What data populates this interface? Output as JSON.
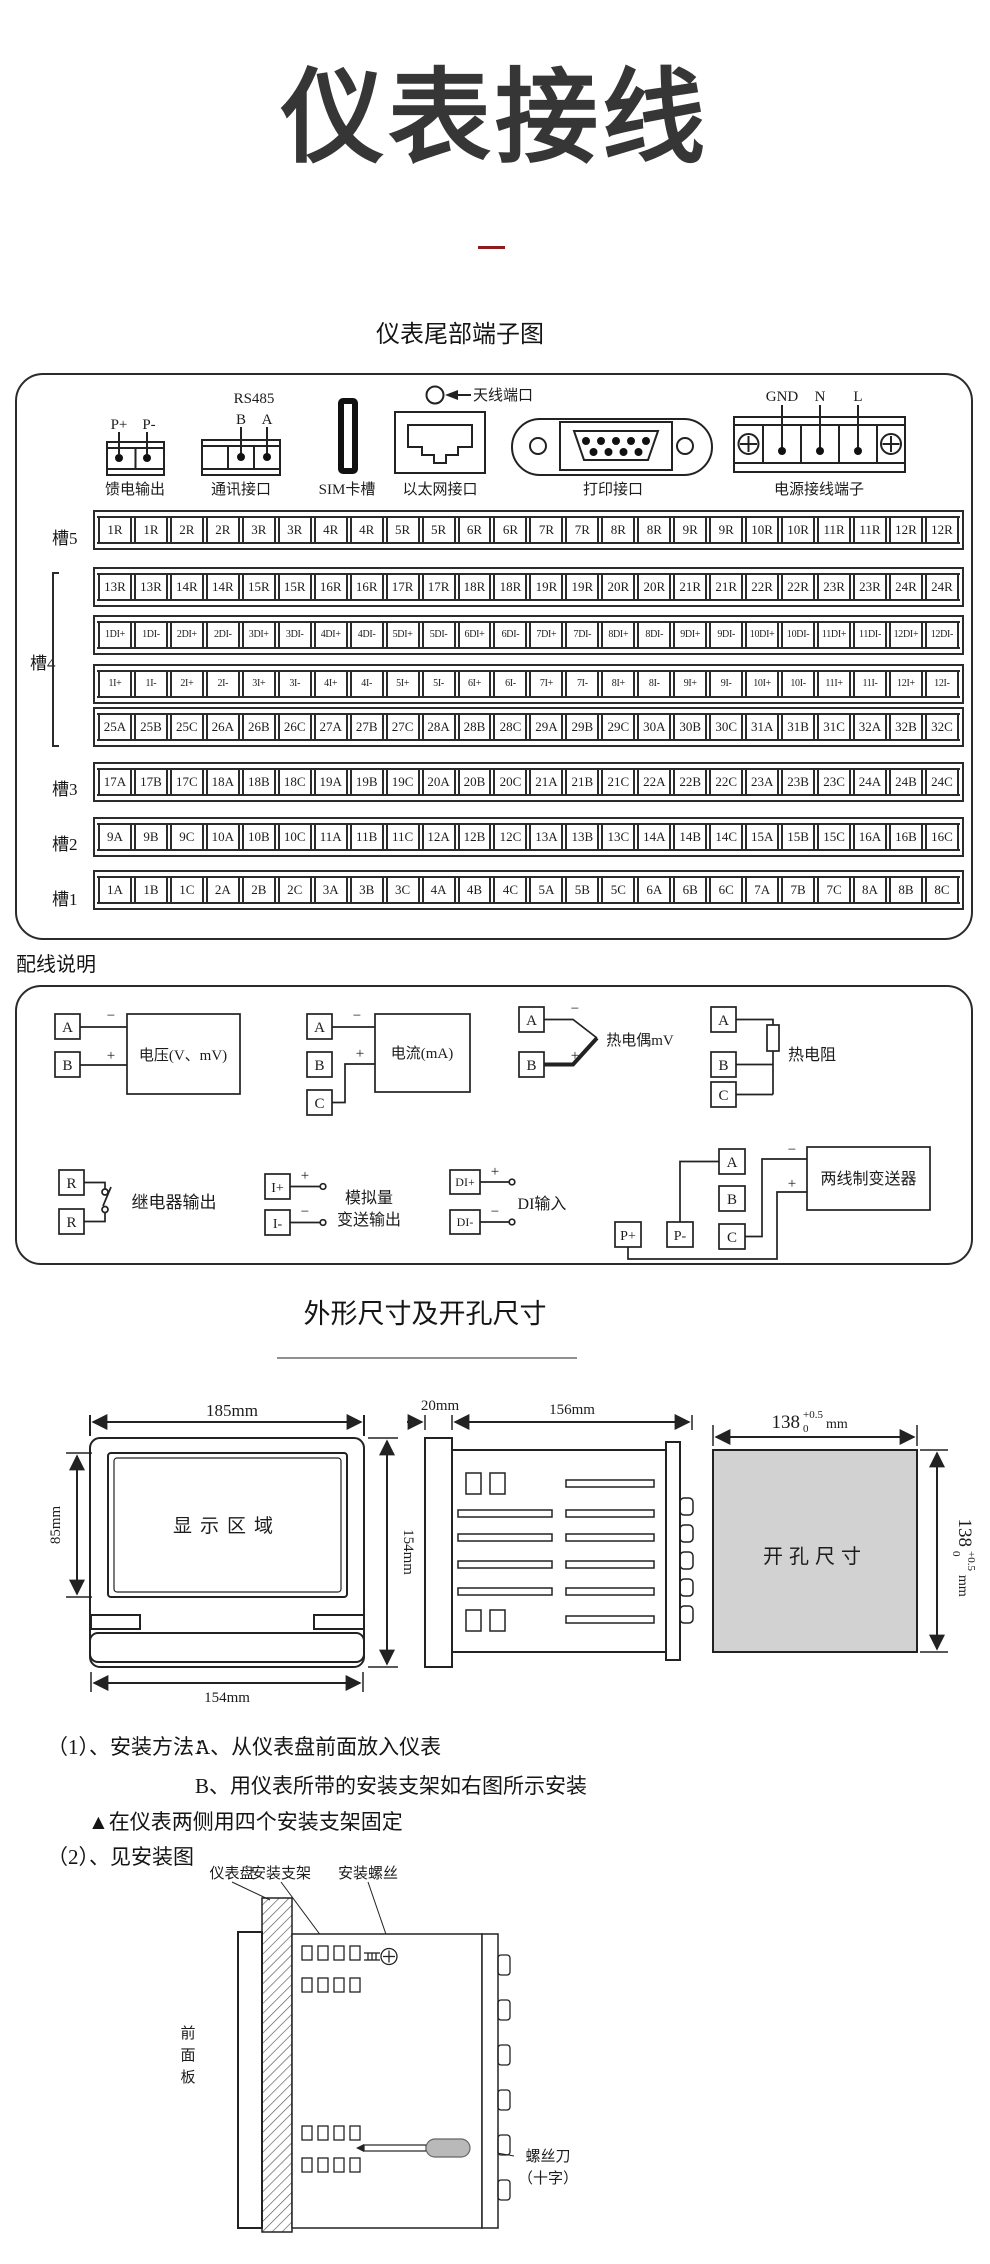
{
  "page": {
    "title": "仪表接线"
  },
  "terminal_section": {
    "heading": "仪表尾部端子图",
    "feed": {
      "pin1": "P+",
      "pin2": "P-",
      "label": "馈电输出"
    },
    "comm": {
      "title": "RS485",
      "pin1": "B",
      "pin2": "A",
      "label": "通讯接口"
    },
    "sim": {
      "label": "SIM卡槽"
    },
    "ethernet": {
      "label": "以太网接口"
    },
    "antenna": {
      "label": "天线端口"
    },
    "printer": {
      "label": "打印接口"
    },
    "power": {
      "pin1": "GND",
      "pin2": "N",
      "pin3": "L",
      "label": "电源接线端子"
    },
    "slots": [
      {
        "name": "槽5",
        "rows": [
          [
            "1R",
            "1R",
            "2R",
            "2R",
            "3R",
            "3R",
            "4R",
            "4R",
            "5R",
            "5R",
            "6R",
            "6R",
            "7R",
            "7R",
            "8R",
            "8R",
            "9R",
            "9R",
            "10R",
            "10R",
            "11R",
            "11R",
            "12R",
            "12R"
          ],
          [
            "13R",
            "13R",
            "14R",
            "14R",
            "15R",
            "15R",
            "16R",
            "16R",
            "17R",
            "17R",
            "18R",
            "18R",
            "19R",
            "19R",
            "20R",
            "20R",
            "21R",
            "21R",
            "22R",
            "22R",
            "23R",
            "23R",
            "24R",
            "24R"
          ]
        ]
      },
      {
        "name": "槽4",
        "rows": [
          [
            "1DI+",
            "1DI-",
            "2DI+",
            "2DI-",
            "3DI+",
            "3DI-",
            "4DI+",
            "4DI-",
            "5DI+",
            "5DI-",
            "6DI+",
            "6DI-",
            "7DI+",
            "7DI-",
            "8DI+",
            "8DI-",
            "9DI+",
            "9DI-",
            "10DI+",
            "10DI-",
            "11DI+",
            "11DI-",
            "12DI+",
            "12DI-"
          ],
          [
            "1I+",
            "1I-",
            "2I+",
            "2I-",
            "3I+",
            "3I-",
            "4I+",
            "4I-",
            "5I+",
            "5I-",
            "6I+",
            "6I-",
            "7I+",
            "7I-",
            "8I+",
            "8I-",
            "9I+",
            "9I-",
            "10I+",
            "10I-",
            "11I+",
            "11I-",
            "12I+",
            "12I-"
          ],
          [
            "25A",
            "25B",
            "25C",
            "26A",
            "26B",
            "26C",
            "27A",
            "27B",
            "27C",
            "28A",
            "28B",
            "28C",
            "29A",
            "29B",
            "29C",
            "30A",
            "30B",
            "30C",
            "31A",
            "31B",
            "31C",
            "32A",
            "32B",
            "32C"
          ]
        ]
      },
      {
        "name": "槽3",
        "rows": [
          [
            "17A",
            "17B",
            "17C",
            "18A",
            "18B",
            "18C",
            "19A",
            "19B",
            "19C",
            "20A",
            "20B",
            "20C",
            "21A",
            "21B",
            "21C",
            "22A",
            "22B",
            "22C",
            "23A",
            "23B",
            "23C",
            "24A",
            "24B",
            "24C"
          ]
        ]
      },
      {
        "name": "槽2",
        "rows": [
          [
            "9A",
            "9B",
            "9C",
            "10A",
            "10B",
            "10C",
            "11A",
            "11B",
            "11C",
            "12A",
            "12B",
            "12C",
            "13A",
            "13B",
            "13C",
            "14A",
            "14B",
            "14C",
            "15A",
            "15B",
            "15C",
            "16A",
            "16B",
            "16C"
          ]
        ]
      },
      {
        "name": "槽1",
        "rows": [
          [
            "1A",
            "1B",
            "1C",
            "2A",
            "2B",
            "2C",
            "3A",
            "3B",
            "3C",
            "4A",
            "4B",
            "4C",
            "5A",
            "5B",
            "5C",
            "6A",
            "6B",
            "6C",
            "7A",
            "7B",
            "7C",
            "8A",
            "8B",
            "8C"
          ]
        ]
      }
    ]
  },
  "wiring_section": {
    "heading": "配线说明",
    "voltage": {
      "t1": "A",
      "t2": "B",
      "minus": "−",
      "plus": "+",
      "label": "电压(V、mV)"
    },
    "current": {
      "t1": "A",
      "t2": "B",
      "t3": "C",
      "minus": "−",
      "plus": "+",
      "label": "电流(mA)"
    },
    "thermocouple": {
      "t1": "A",
      "t2": "B",
      "minus": "−",
      "plus": "+",
      "label": "热电偶mV"
    },
    "rtd": {
      "t1": "A",
      "t2": "B",
      "t3": "C",
      "label": "热电阻"
    },
    "relay": {
      "t1": "R",
      "t2": "R",
      "label": "继电器输出"
    },
    "analog_out": {
      "t1": "I+",
      "t2": "I-",
      "plus": "+",
      "minus": "−",
      "label1": "模拟量",
      "label2": "变送输出"
    },
    "di": {
      "t1": "DI+",
      "t2": "DI-",
      "plus": "+",
      "minus": "−",
      "label": "DI输入"
    },
    "transmitter": {
      "p1": "P+",
      "p2": "P-",
      "t1": "A",
      "t2": "B",
      "t3": "C",
      "minus": "−",
      "plus": "+",
      "label": "两线制变送器"
    }
  },
  "dim_section": {
    "heading": "外形尺寸及开孔尺寸",
    "front": {
      "top": "185mm",
      "left": "85mm",
      "right": "154mm",
      "bottom": "154mm",
      "display": "显示区域"
    },
    "side": {
      "flange": "20mm",
      "body": "156mm"
    },
    "cutout": {
      "label": "开孔尺寸",
      "value": "138",
      "tol_top": "+0.5",
      "tol_bottom": "0",
      "unit": "mm"
    }
  },
  "install_section": {
    "item1": "（1）、安装方法：",
    "item1_a": "A、从仪表盘前面放入仪表",
    "item1_b": "B、用仪表所带的安装支架如右图所示安装",
    "note": "▲在仪表两侧用四个安装支架固定",
    "item2": "（2）、见安装图",
    "diagram": {
      "panel": "仪表盘",
      "bracket": "安装支架",
      "screw": "安装螺丝",
      "front_panel": [
        "前",
        "面",
        "板"
      ],
      "screwdriver1": "螺丝刀",
      "screwdriver2": "（十字）"
    }
  }
}
